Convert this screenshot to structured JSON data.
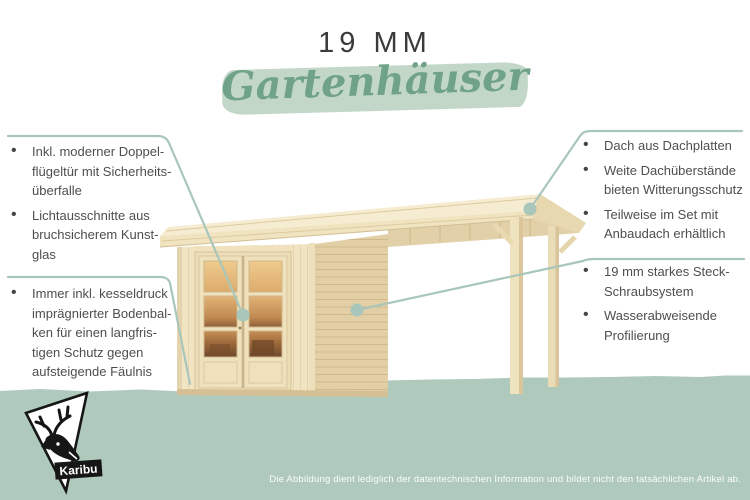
{
  "colors": {
    "accent": "#6FA287",
    "brush": "#C3D7C9",
    "band": "#AFC9BC",
    "callout": "#A9C6BA",
    "text": "#4E4E4C"
  },
  "header": {
    "size_label": "19 MM",
    "category_label": "Gartenhäuser"
  },
  "annotations": {
    "left_top": {
      "items": [
        "Inkl. moderner Doppel-\nflügeltür mit Sicherheits-\nüberfalle",
        "Lichtausschnitte aus\nbruchsicherem Kunst-\nglas"
      ]
    },
    "left_bottom": {
      "items": [
        "Immer inkl. kesseldruck\nimprägnierter Bodenbal-\nken für einen langfris-\ntigen Schutz gegen\naufsteigende Fäulnis"
      ]
    },
    "right_top": {
      "items": [
        "Dach aus Dachplatten",
        "Weite Dachüberstände\nbieten Witterungsschutz",
        "Teilweise im Set mit\nAnbaudach erhältlich"
      ]
    },
    "right_bottom": {
      "items": [
        "19 mm starkes Steck-\nSchraubsystem",
        "Wasserabweisende\nProfilierung"
      ]
    }
  },
  "logo": {
    "brand": "Karibu"
  },
  "footer": {
    "disclaimer": "Die Abbildung dient lediglich der datentechnischen Information und bildet nicht den tatsächlichen Artikel ab."
  }
}
